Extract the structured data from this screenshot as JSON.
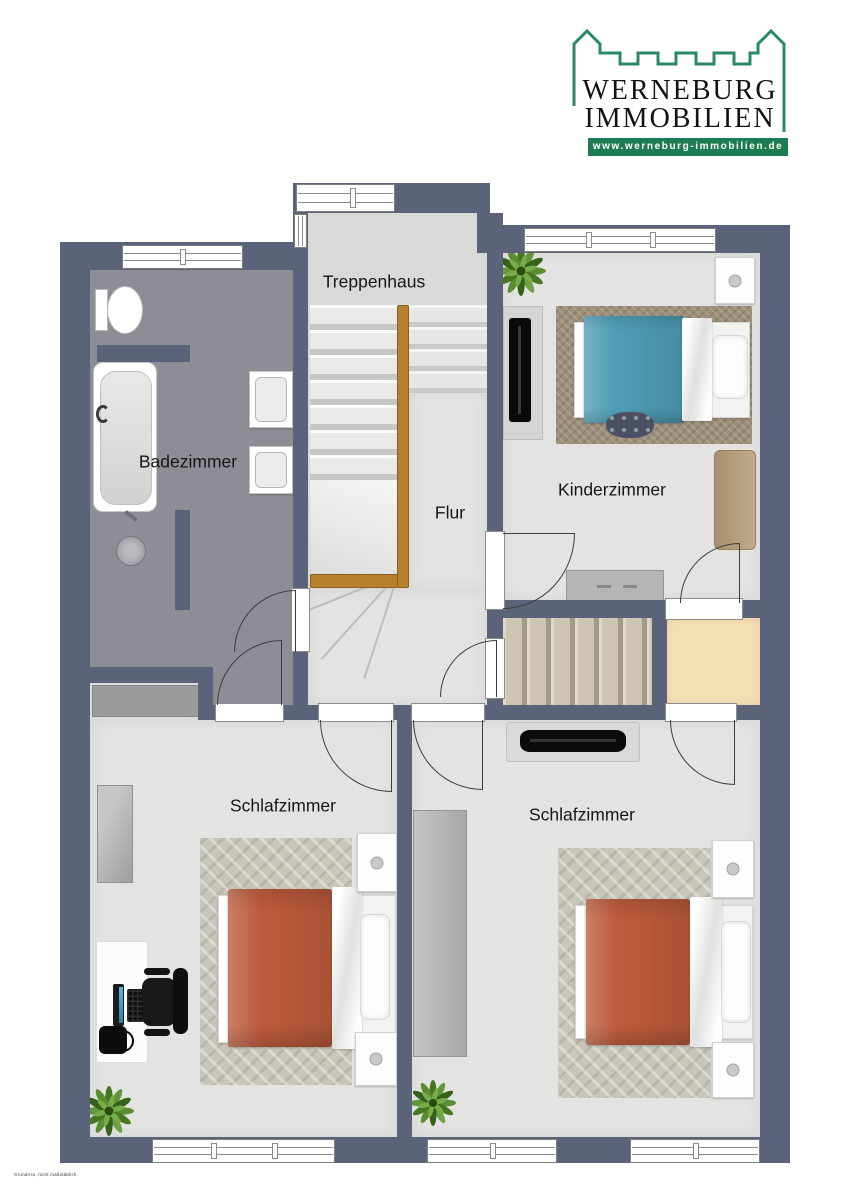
{
  "logo": {
    "line1": "WERNEBURG",
    "line2": "IMMOBILIEN",
    "website": "www.werneburg-immobilien.de"
  },
  "rooms": {
    "treppenhaus": "Treppenhaus",
    "badezimmer": "Badezimmer",
    "kinderzimmer": "Kinderzimmer",
    "flur": "Flur",
    "schlafzimmer_left": "Schlafzimmer",
    "schlafzimmer_right": "Schlafzimmer"
  },
  "footnote": "Grundriss, nicht maßstäblich",
  "colors": {
    "wall": "#5a6379",
    "floor": "#e3e3e1",
    "bath_tile": "#8d8d95",
    "stair_carpet": "#cec5b2",
    "storage_floor": "#f4dfb4",
    "wood": "#b5812e",
    "child_blanket": "#4f9fb7",
    "adult_blanket": "#bd5c3d",
    "brand_green": "#1e7c53",
    "castle_green": "#2b8a66"
  }
}
